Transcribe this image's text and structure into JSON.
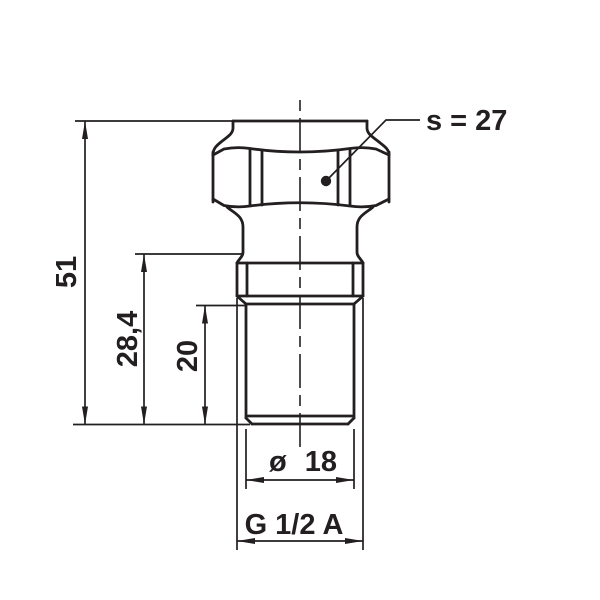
{
  "drawing": {
    "type": "technical-dimension-drawing",
    "subject": "threaded hex fitting, side elevation",
    "background_color": "#ffffff",
    "line_color": "#231f20",
    "labels": {
      "overall_length": "51",
      "shank_length": "28,4",
      "thread_length": "20",
      "diameter": "ø 18",
      "thread_spec": "G 1/2 A",
      "wrench_size": "s = 27"
    }
  }
}
